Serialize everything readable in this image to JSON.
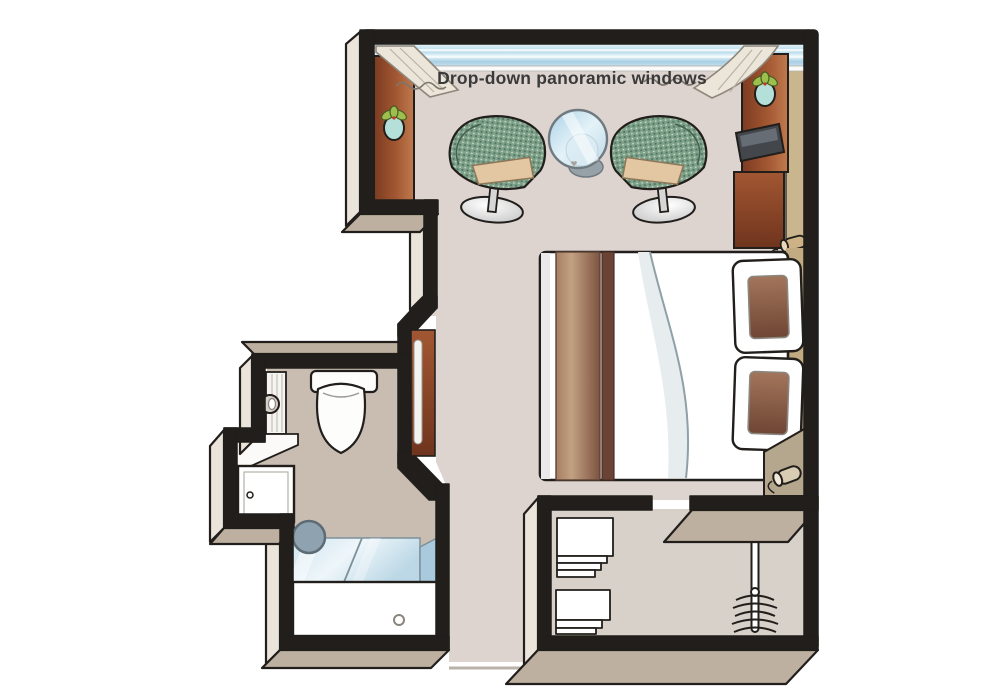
{
  "labels": {
    "window": "Drop-down panoramic windows"
  },
  "colors": {
    "background": "#ffffff",
    "outline": "#211e1b",
    "floor_main": "#ddd4d0",
    "floor_bath": "#c9bdb2",
    "floor_closet": "#d8d1ca",
    "wall_top_tan": "#beb0a0",
    "wall_face_cream": "#eae4db",
    "wall_lining_tan": "#c9b68e",
    "glass_blue": "#c6e1ee",
    "glass_blue_dark": "#a9cadd",
    "brown_light": "#b06538",
    "brown_dark": "#7c3b21",
    "runner_light": "#c2a183",
    "runner_dark": "#6b4236",
    "pillow_brown": "#8a5f48",
    "chair_green": "#7ea18a",
    "chair_green_dark": "#4d7260",
    "cushion_tan": "#e3c6a2",
    "plant_green": "#9cbf4e",
    "pot_teal": "#b5e0da",
    "shower_head": "#8ea3af",
    "lamp_cream": "#d8cdb2",
    "curtain_cream": "#ebe6d9"
  },
  "elements": [
    "panoramic-window",
    "curtain-left",
    "curtain-right",
    "tub-armchair-left",
    "tub-armchair-right",
    "glass-cocktail-table",
    "double-bed",
    "bed-runner",
    "pillows",
    "headboard-shelf",
    "bedside-lamp",
    "tall-cabinet",
    "media-cabinet",
    "tv",
    "desk-cabinet",
    "plants",
    "full-length-mirror",
    "toilet",
    "toilet-paper-holder",
    "vanity-counter",
    "vanity-cabinet",
    "shower",
    "shower-head",
    "closet-shelves",
    "clothes-rail",
    "rolled-towel"
  ]
}
